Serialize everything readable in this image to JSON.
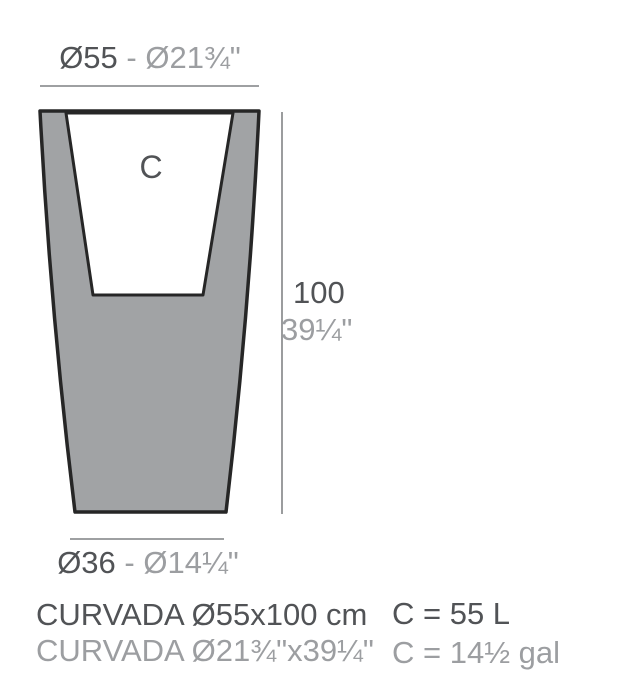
{
  "colors": {
    "dark_text": "#515356",
    "light_text": "#9c9ea1",
    "pot_fill": "#a1a3a5",
    "outline": "#262626",
    "dim_line": "#909294",
    "cavity_fill": "#ffffff",
    "background": "#ffffff"
  },
  "diagram": {
    "cavity_label": "C",
    "top_dimension": {
      "metric": "Ø55",
      "imperial": "- Ø21¾\""
    },
    "height_dimension": {
      "metric": "100",
      "imperial": "39¼\""
    },
    "bottom_dimension": {
      "metric": "Ø36",
      "imperial": "- Ø14¼\""
    }
  },
  "footer": {
    "product_metric": "CURVADA Ø55x100 cm",
    "product_imperial": "CURVADA Ø21¾\"x39¼\"",
    "capacity_metric": "C = 55 L",
    "capacity_imperial": "C = 14½ gal"
  }
}
